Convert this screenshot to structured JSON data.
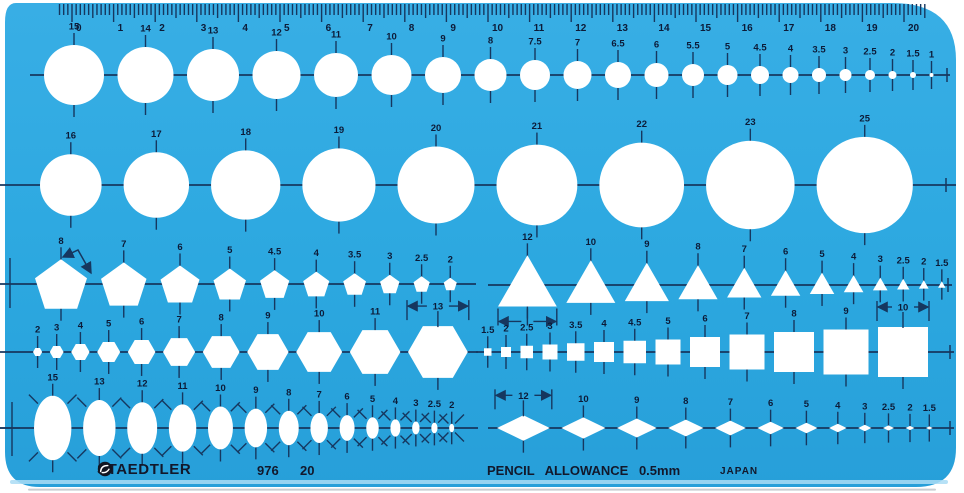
{
  "colors": {
    "body_blue": "#2CA8E0",
    "body_blue_light": "#38AEE5",
    "body_blue_deep": "#279FD9",
    "ink": "#16375F",
    "label_text": "#0C1B38",
    "cutout_white": "#FFFFFF",
    "edge_highlight": "#AADCF5"
  },
  "ruler": {
    "numbers": [
      "0",
      "1",
      "2",
      "3",
      "4",
      "5",
      "6",
      "7",
      "8",
      "9",
      "10",
      "11",
      "12",
      "13",
      "14",
      "15",
      "16",
      "17",
      "18",
      "19",
      "20"
    ]
  },
  "rows": [
    {
      "id": "circles-small",
      "shape": "circle",
      "labels": [
        "15",
        "14",
        "13",
        "12",
        "11",
        "10",
        "9",
        "8",
        "7.5",
        "7",
        "6.5",
        "6",
        "5.5",
        "5",
        "4.5",
        "4",
        "3.5",
        "3",
        "2.5",
        "2",
        "1.5",
        "1"
      ]
    },
    {
      "id": "circles-large",
      "shape": "circle",
      "labels": [
        "16",
        "17",
        "18",
        "19",
        "20",
        "21",
        "22",
        "23",
        "25"
      ]
    },
    {
      "id": "pentagons",
      "shape": "pentagon",
      "labels": [
        "8",
        "7",
        "6",
        "5",
        "4.5",
        "4",
        "3.5",
        "3",
        "2.5",
        "2"
      ]
    },
    {
      "id": "triangles",
      "shape": "triangle",
      "labels": [
        "12",
        "10",
        "9",
        "8",
        "7",
        "6",
        "5",
        "4",
        "3",
        "2.5",
        "2",
        "1.5"
      ]
    },
    {
      "id": "hexagons",
      "shape": "hexagon",
      "labels": [
        "2",
        "3",
        "4",
        "5",
        "6",
        "7",
        "8",
        "9",
        "10",
        "11",
        "13"
      ]
    },
    {
      "id": "squares",
      "shape": "square",
      "labels": [
        "1.5",
        "2",
        "2.5",
        "3",
        "3.5",
        "4",
        "4.5",
        "5",
        "6",
        "7",
        "8",
        "9",
        "10"
      ]
    },
    {
      "id": "ellipses",
      "shape": "ellipse",
      "labels": [
        "15",
        "13",
        "12",
        "11",
        "10",
        "9",
        "8",
        "7",
        "6",
        "5",
        "4",
        "3",
        "2.5",
        "2"
      ]
    },
    {
      "id": "diamonds",
      "shape": "diamond",
      "labels": [
        "12",
        "10",
        "9",
        "8",
        "7",
        "6",
        "5",
        "4",
        "3",
        "2.5",
        "2",
        "1.5"
      ]
    }
  ],
  "footer": {
    "brand": "STAEDTLER",
    "model": "976",
    "size": "20",
    "allowance": "PENCIL ALLOWANCE 0.5mm",
    "origin": "JAPAN"
  }
}
